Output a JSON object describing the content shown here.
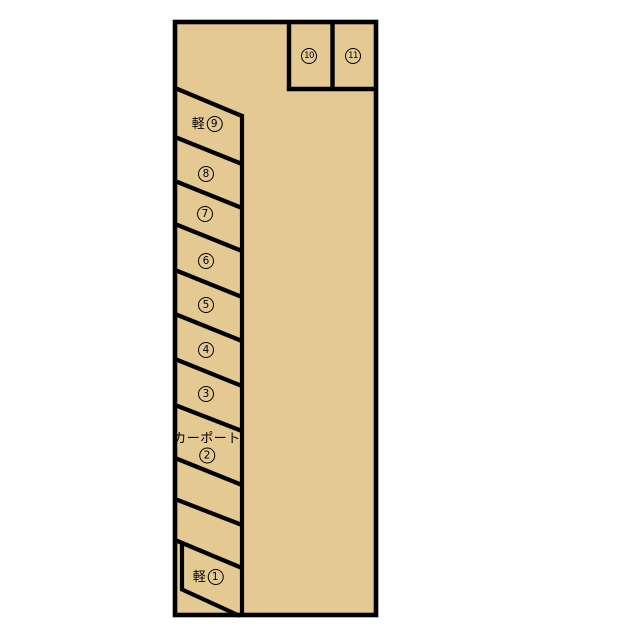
{
  "diagram": {
    "type": "parking-lot-layout",
    "background_color": "#ffffff",
    "lot_fill_color": "#e4c993",
    "line_color": "#000000"
  },
  "upper_row": {
    "spaces": [
      {
        "label": "⑩",
        "number": "10"
      },
      {
        "label": "⑪",
        "number": "11"
      }
    ]
  },
  "stall_column": {
    "spaces": [
      {
        "label": "軽⑨",
        "prefix": "軽",
        "number": "9"
      },
      {
        "label": "⑧",
        "prefix": "",
        "number": "8"
      },
      {
        "label": "⑦",
        "prefix": "",
        "number": "7"
      },
      {
        "label": "⑥",
        "prefix": "",
        "number": "6"
      },
      {
        "label": "⑤",
        "prefix": "",
        "number": "5"
      },
      {
        "label": "④",
        "prefix": "",
        "number": "4"
      },
      {
        "label": "③",
        "prefix": "",
        "number": "3"
      },
      {
        "label": "カーポート②",
        "prefix": "カーポート",
        "number": "2"
      },
      {
        "label": "軽①",
        "prefix": "軽",
        "number": "1"
      }
    ]
  }
}
